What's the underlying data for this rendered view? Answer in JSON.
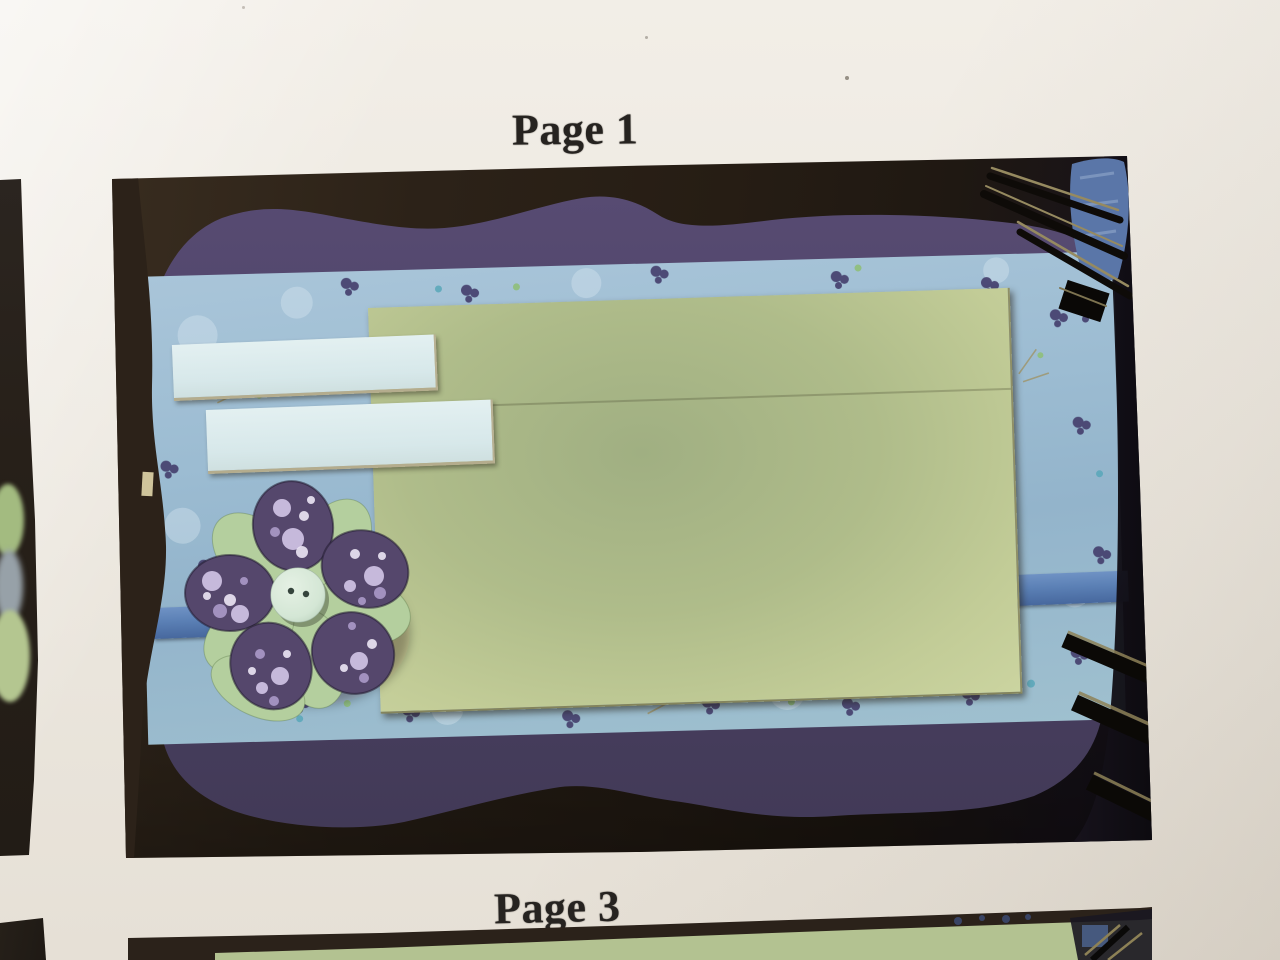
{
  "page": {
    "background": "#ece7e0",
    "labels": [
      {
        "id": "page-1",
        "text": "Page 1"
      },
      {
        "id": "page-3",
        "text": "Page 3"
      }
    ]
  },
  "palette": {
    "photo_background_brown": "#261d14",
    "mat_purple": "#4e4366",
    "floral_paper_blue": "#9cbcd2",
    "cardstock_green": "#b8c48e",
    "journal_strip_blue": "#dcebec",
    "ribbon_blue": "#5b80b5",
    "petal_purple": "#55476c",
    "petal_dot_lavender": "#cdc0e1",
    "leaf_green": "#b4cf9e",
    "button_mint": "#d9e9da",
    "binding_wire_black": "#0d0a07",
    "wire_highlight_khaki": "#8d8157",
    "denim_blue": "#5a76a8",
    "page3_green": "#b3c291"
  }
}
